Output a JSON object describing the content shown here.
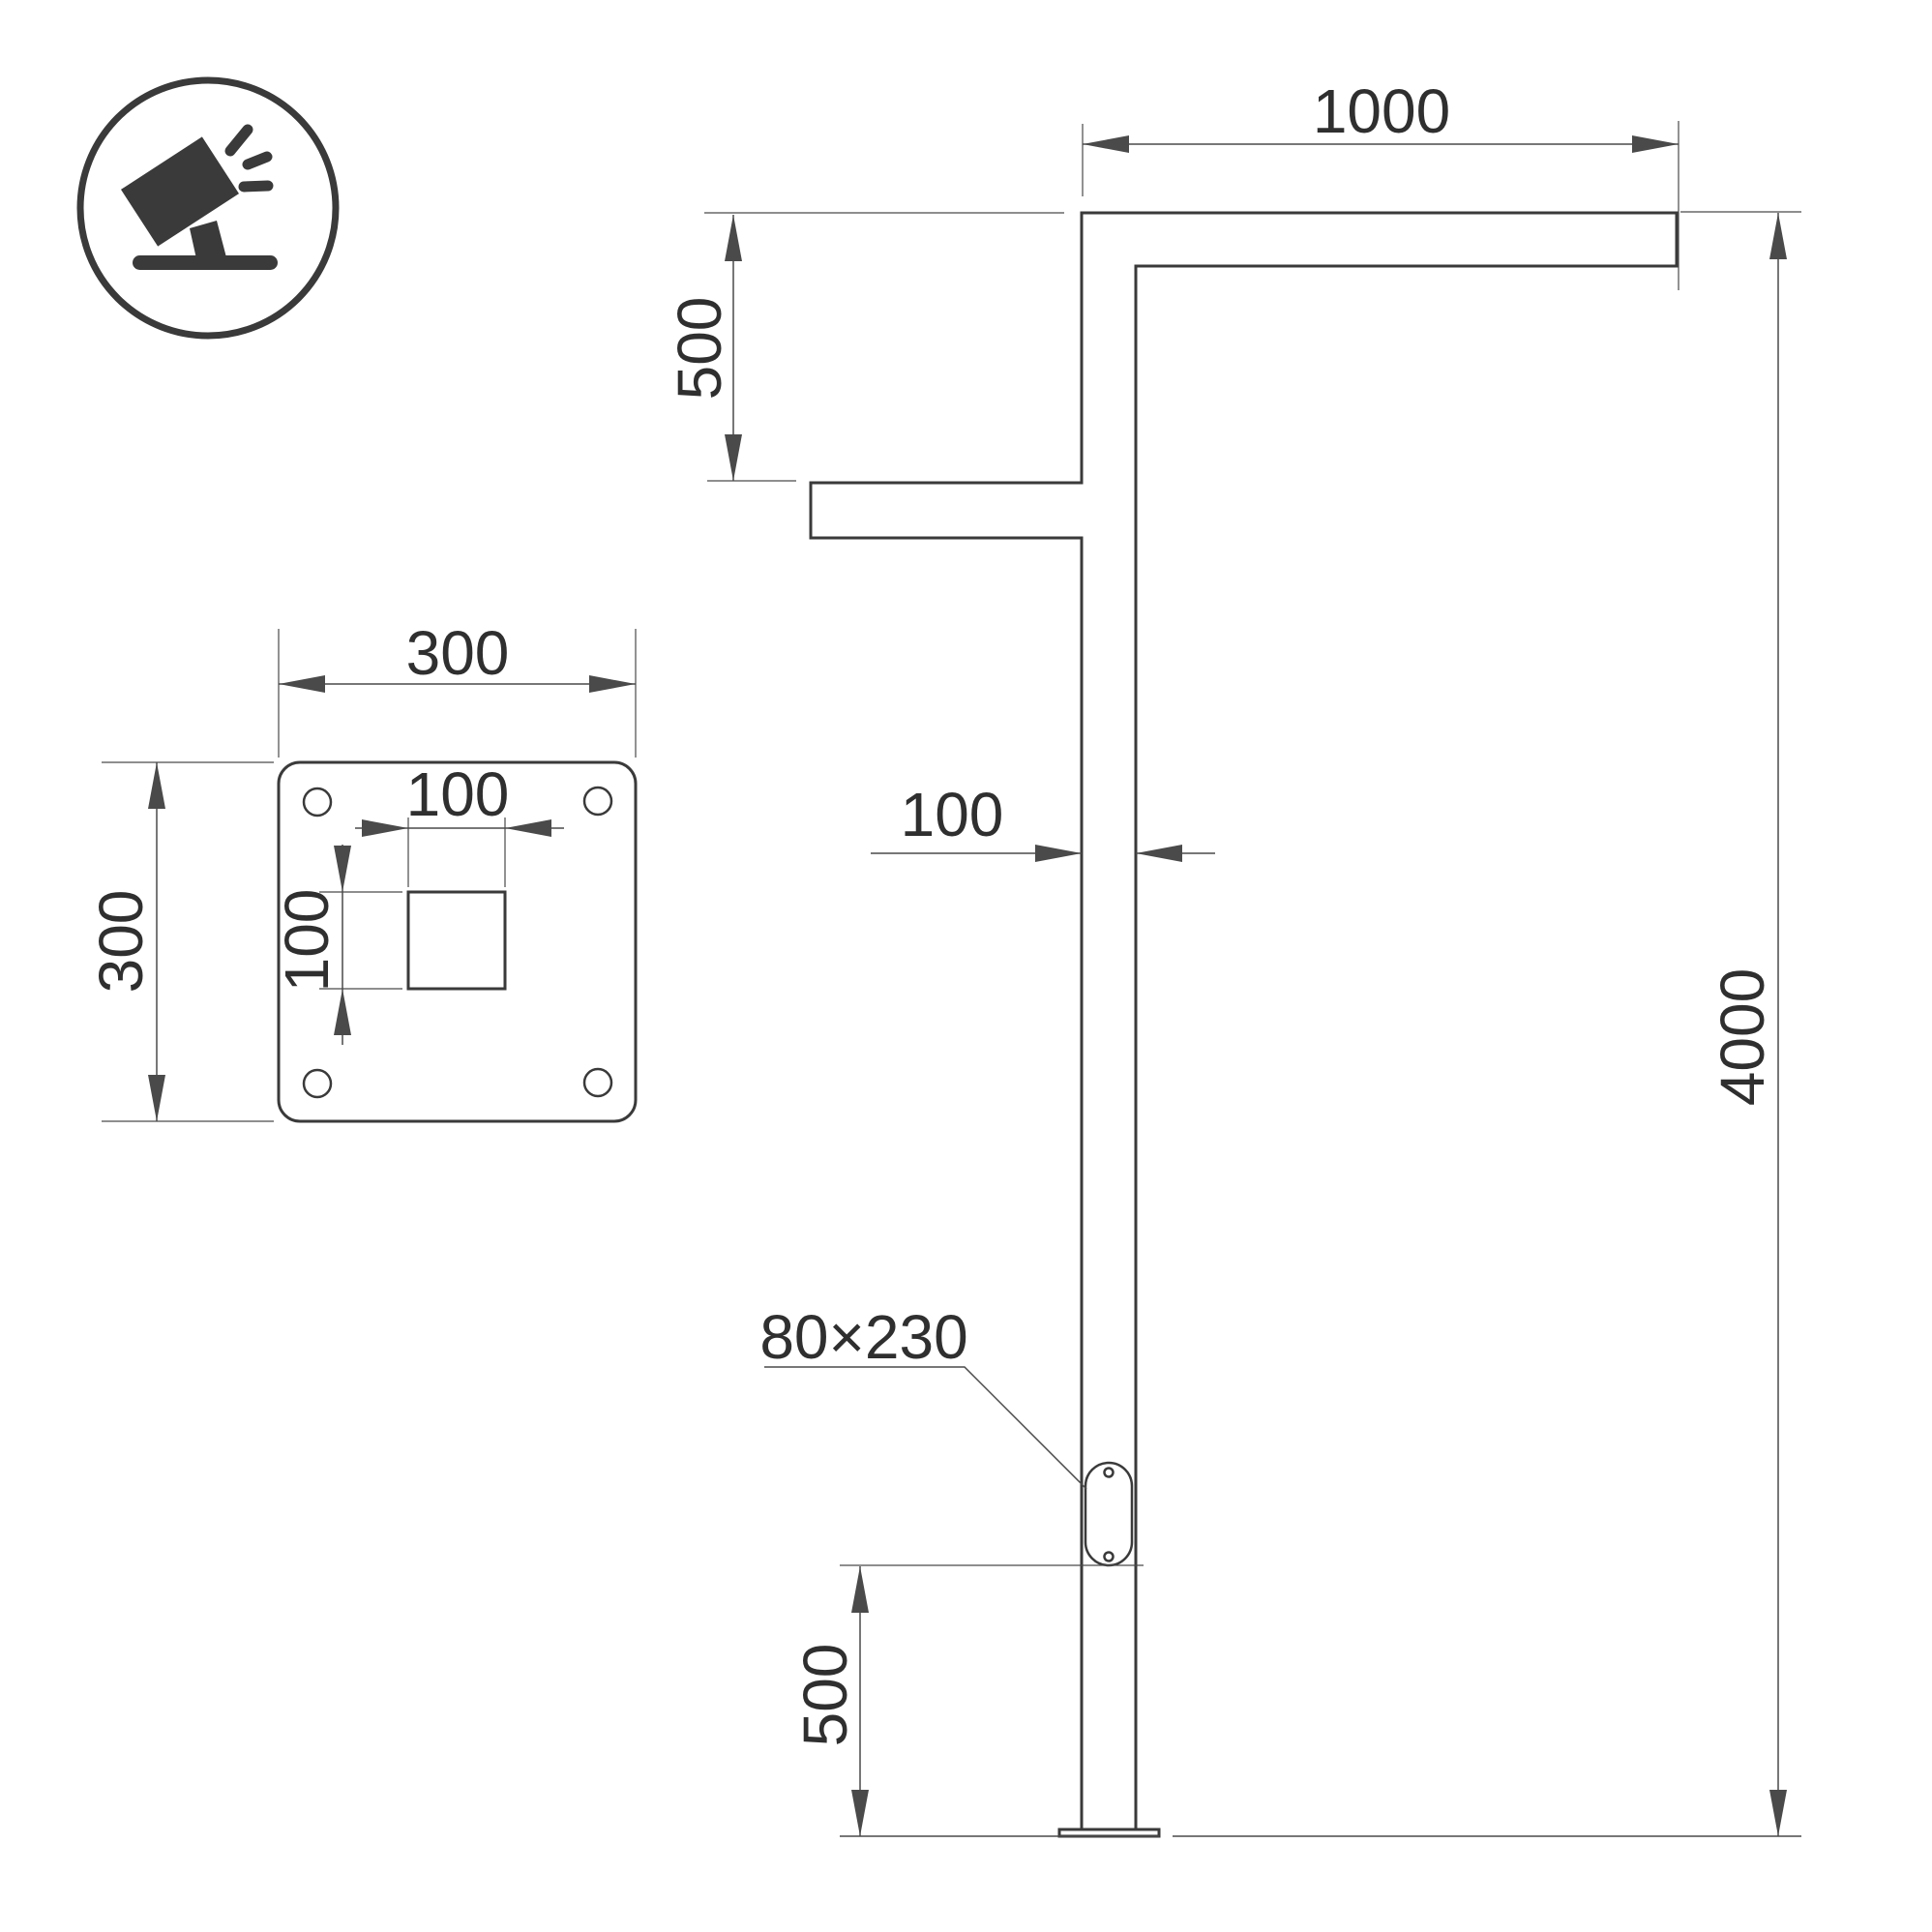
{
  "title": "Street pole luminaire dimensional drawing",
  "colors": {
    "background": "#ffffff",
    "object_line": "#3a3a3a",
    "dimension_line": "#4a4a4a",
    "text": "#2f2f2f"
  },
  "icon": {
    "name": "tilted-floodlight-on-ground"
  },
  "pole_view": {
    "dim_arm_length": "1000",
    "dim_arm_drop": "500",
    "dim_pole_width": "100",
    "dim_total_height": "4000",
    "dim_hand_hole_offset": "500",
    "hand_hole_label": "80×230"
  },
  "plate_view": {
    "dim_plate_width": "300",
    "dim_plate_height": "300",
    "dim_socket_width": "100",
    "dim_socket_height": "100"
  }
}
